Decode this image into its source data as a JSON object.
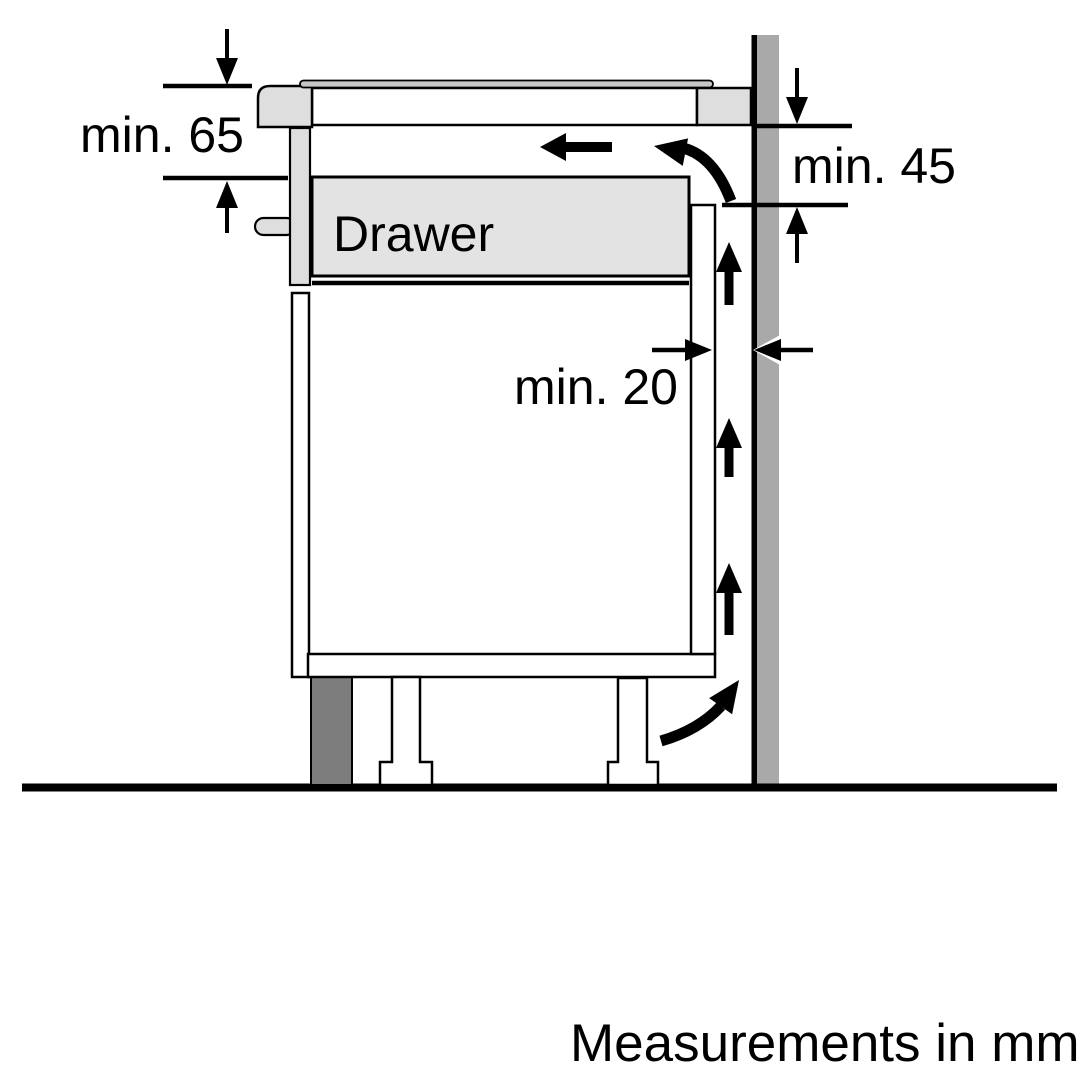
{
  "diagram": {
    "type": "appliance-installation-side-view",
    "labels": {
      "drawer": "Drawer",
      "clearance_top": "min. 65",
      "clearance_right": "min. 45",
      "clearance_back": "min. 20",
      "footer": "Measurements in mm"
    },
    "values": {
      "clearance_top_mm": 65,
      "clearance_right_mm": 45,
      "clearance_back_mm": 20
    },
    "colors": {
      "background": "#ffffff",
      "line": "#000000",
      "panel_light": "#dedede",
      "drawer_fill": "#e3e3e3",
      "glass_fill": "#c6c6c6",
      "wall_fill": "#a9a9a9",
      "plinth_fill": "#7d7d7d"
    }
  }
}
